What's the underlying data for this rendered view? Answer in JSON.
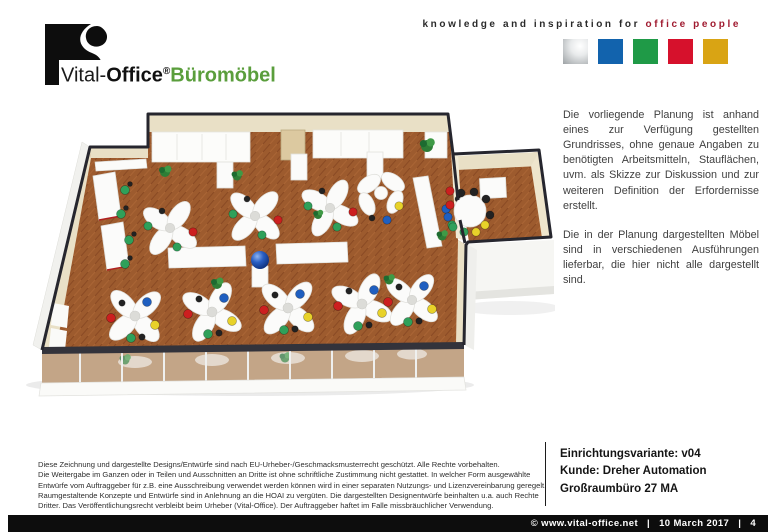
{
  "header": {
    "logo": {
      "brand_thin": "Vital-",
      "brand_bold": "Office",
      "registered": "®",
      "brand_green": "Büromöbel",
      "green_color": "#5a9e3c"
    },
    "tagline": {
      "prefix": "knowledge and inspiration for ",
      "highlight": "office people",
      "highlight_color": "#a01b30"
    },
    "squares": [
      {
        "name": "silver",
        "color": "#b9bdbf"
      },
      {
        "name": "blue",
        "color": "#1263ad"
      },
      {
        "name": "green",
        "color": "#1f9a47"
      },
      {
        "name": "red",
        "color": "#d6112c"
      },
      {
        "name": "gold",
        "color": "#d9a414"
      }
    ]
  },
  "notes": {
    "para1": "Die vorliegende  Planung ist anhand eines zur Verfügung  gestellten Grundrisses, ohne genaue Angaben zu benötigten Arbeitsmitteln, Stauflächen, uvm. als Skizze zur Diskussion und zur weiteren Definition der Erfordernisse erstellt.",
    "para2": "Die in der Planung dargestellten Möbel sind in verschiedenen  Ausführungen lieferbar, die hier nicht alle dargestellt sind."
  },
  "legal": {
    "lines": [
      "Diese Zeichnung und dargestellte Designs/Entwürfe sind nach EU-Urheber-/Geschmacksmusterrecht geschützt. Alle Rechte vorbehalten.",
      "Die Weitergabe im Ganzen oder in Teilen und Ausschnitten an Dritte ist ohne schriftliche Zustimmung nicht gestattet. In welcher Form ausgewählte",
      "Entwürfe vom Auftraggeber für z.B. eine Ausschreibung verwendet werden können wird in einer separaten Nutzungs- und Lizenzvereinbarung geregelt.",
      "Raumgestaltende Konzepte und Entwürfe sind in Anlehnung an die HOAI zu vergüten. Die dargestellten Designentwürfe beinhalten u.a. auch Rechte",
      "Dritter. Das Veröffentlichungsrecht verbleibt beim Urheber (Vital-Office). Der Auftraggeber haftet im Falle missbräuchlicher Verwendung."
    ]
  },
  "project": {
    "line1": "Einrichtungsvariante: v04",
    "line2": "Kunde: Dreher Automation",
    "line3": "Großraumbüro 27 MA"
  },
  "footer": {
    "copyright": "© www.vital-office.net",
    "separator": "|",
    "date": "10 March 2017",
    "page": "4"
  },
  "floor_plan": {
    "palette": {
      "floor": "#9d5b2e",
      "walls": "#e9e0c6",
      "outline": "#26262e",
      "furniture": "#fbfbfa",
      "chair_red": "#cc1f1f",
      "chair_blue": "#1f5fc0",
      "chair_green": "#2fa05a",
      "chair_yellow": "#e8d22a",
      "chair_black": "#222222",
      "plant": "#2e7d36",
      "sphere": "#1d4fae",
      "glass": "#b58a60"
    }
  }
}
